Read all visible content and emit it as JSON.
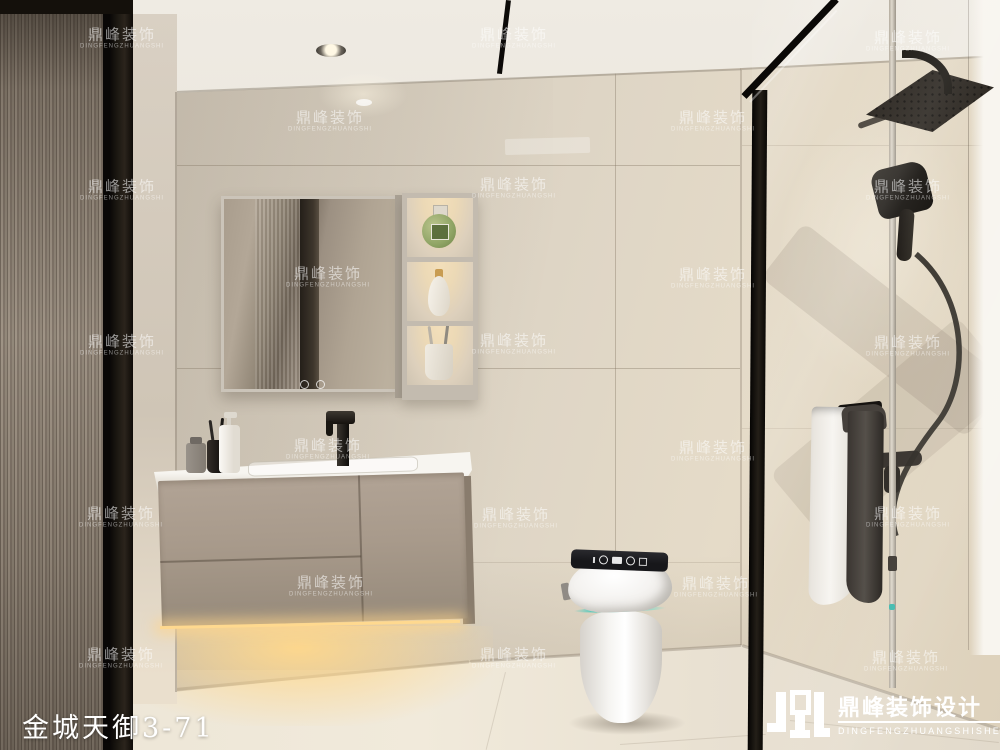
{
  "caption": {
    "project_title": "金城天御3-71"
  },
  "watermark": {
    "cn": "鼎峰装饰",
    "en": "DINGFENGZHUANGSHI",
    "color": "#ffffff",
    "opacity": 0.55,
    "positions": [
      [
        122,
        38
      ],
      [
        514,
        38
      ],
      [
        908,
        41
      ],
      [
        330,
        121
      ],
      [
        713,
        121
      ],
      [
        122,
        190
      ],
      [
        514,
        188
      ],
      [
        908,
        190
      ],
      [
        328,
        277
      ],
      [
        713,
        278
      ],
      [
        122,
        345
      ],
      [
        514,
        344
      ],
      [
        908,
        346
      ],
      [
        328,
        449
      ],
      [
        713,
        451
      ],
      [
        121,
        517
      ],
      [
        516,
        518
      ],
      [
        908,
        517
      ],
      [
        331,
        586
      ],
      [
        716,
        587
      ],
      [
        121,
        658
      ],
      [
        514,
        658
      ],
      [
        906,
        661
      ]
    ]
  },
  "logo": {
    "cn": "鼎峰装饰设计",
    "en": "DINGFENGZHUANGSHISHEJI"
  },
  "palette": {
    "wall": "#d9d1c3",
    "wall_light": "#e6dcc8",
    "ceiling": "#e9e4da",
    "floor": "#ece5d6",
    "floor_glow": "#f6e3b9",
    "door_glass": "#8a7e71",
    "door_frame": "#14100b",
    "left_wall": "#d3cabd",
    "cabinet": "#a89a8b",
    "cabinet_side": "#897c6d",
    "counter": "#f3f1ec",
    "mirror_frame": "#cbc4b9",
    "shelf_glow": "#f3dfba",
    "toilet_white": "#f8f7f5",
    "toilet_panel": "#17171a",
    "toilet_accent": "#49ded0",
    "fixture_black": "#221f1b",
    "towel_white": "#f3f0eb",
    "towel_dark": "#55504a",
    "bottle_green": "#8fa465"
  }
}
